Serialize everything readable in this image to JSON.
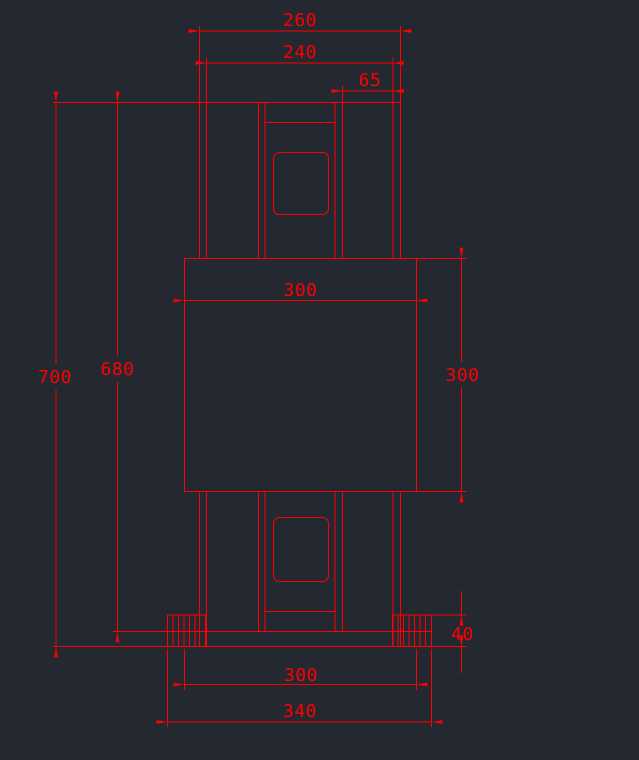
{
  "canvas": {
    "background_color": "#232831",
    "line_color": "#ff0000",
    "width_px": 639,
    "height_px": 760
  },
  "drawing": {
    "view_type": "cad-orthographic-section-view",
    "dims": {
      "top_outer_width": "260",
      "top_inner_width": "240",
      "top_right_offset": "65",
      "body_width": "300",
      "body_height": "300",
      "overall_height": "700",
      "height_to_base_top": "680",
      "foot_height": "40",
      "base_inner_width": "300",
      "base_outer_width": "340"
    }
  }
}
